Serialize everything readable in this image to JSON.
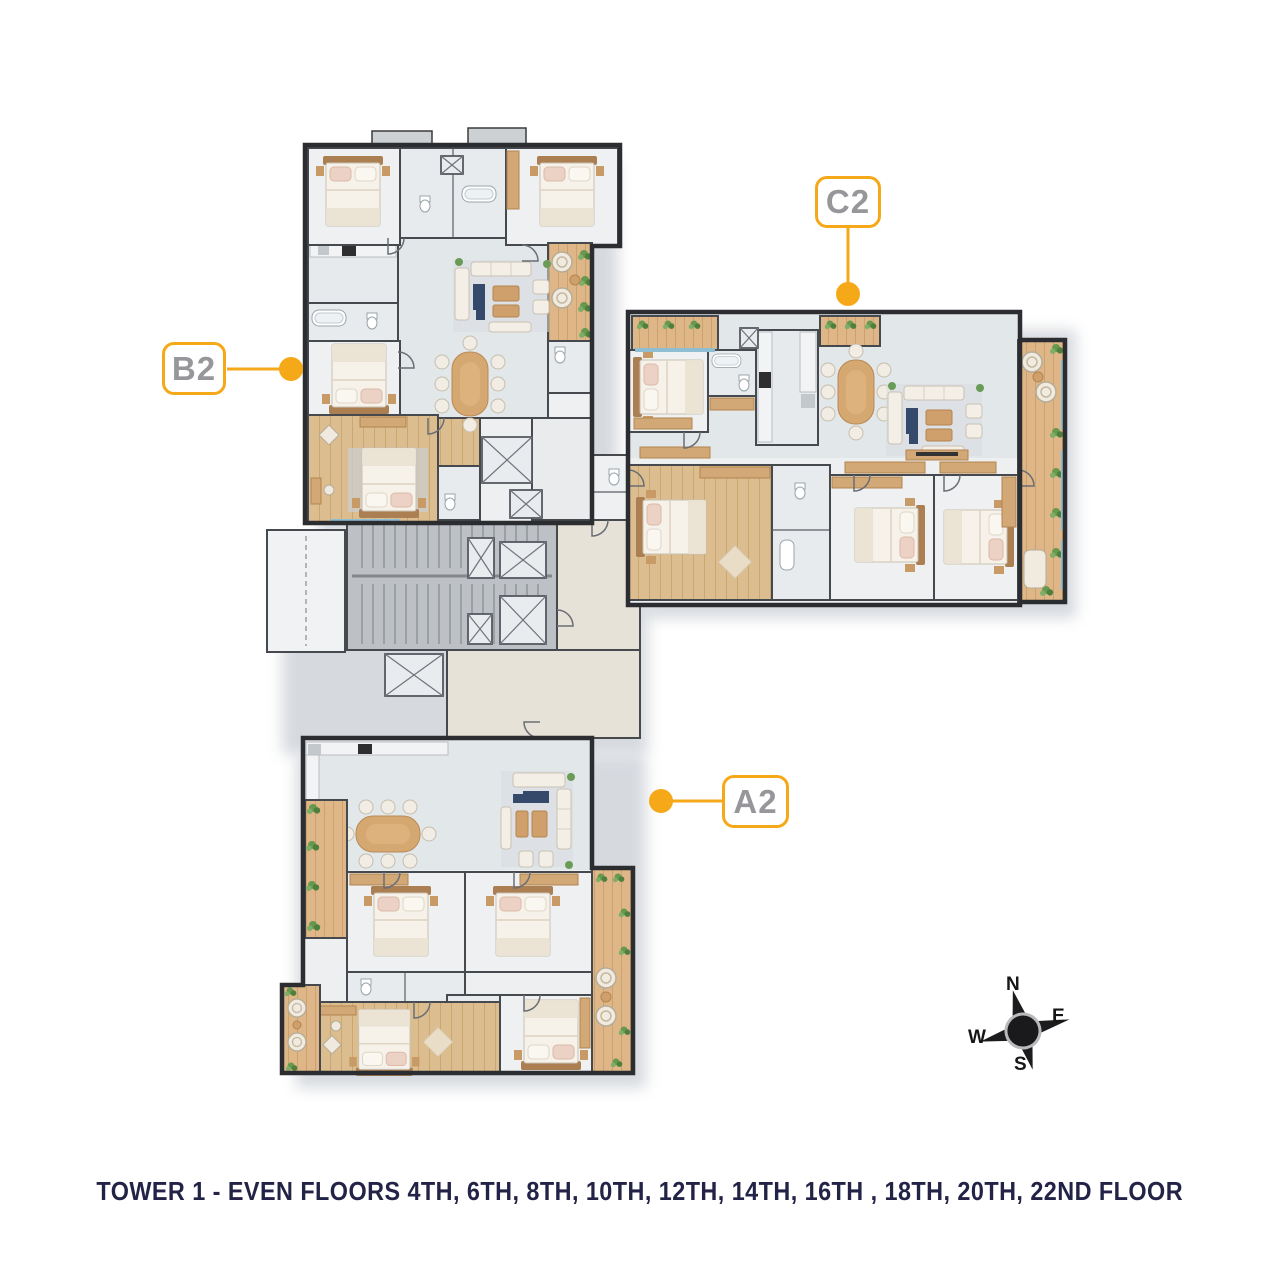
{
  "units": {
    "b2": {
      "label": "B2"
    },
    "c2": {
      "label": "C2"
    },
    "a2": {
      "label": "A2"
    }
  },
  "compass": {
    "north": "N",
    "east": "E",
    "south": "S",
    "west": "W"
  },
  "caption": {
    "text": "TOWER 1 - EVEN FLOORS 4TH, 6TH, 8TH, 10TH, 12TH, 14TH, 16TH , 18TH, 20TH, 22ND FLOOR"
  },
  "colors": {
    "accent_orange": "#F5A818",
    "unit_label_gray": "#97979B",
    "caption_navy": "#232347",
    "balcony_wood": "#DDB584",
    "bedroom_wood_floor": "#DCBD8F",
    "window_blue": "#8FBDD1"
  }
}
